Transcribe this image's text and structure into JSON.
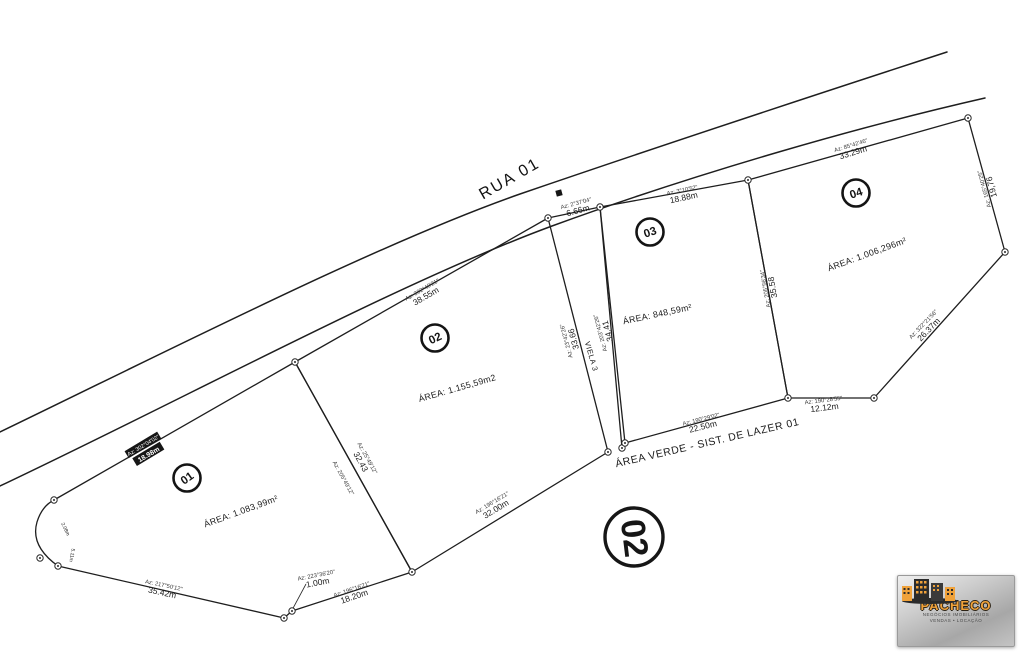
{
  "names": {
    "road_name": "RUA 01",
    "area_verde": "ÁREA VERDE - SIST. DE LAZER 01",
    "viela": "VIELA 3",
    "block_number": "02"
  },
  "lots": [
    {
      "number": "01",
      "area": "ÁREA: 1.083,99m²",
      "bubble": {
        "x": 187,
        "y": 478,
        "rot": -35
      },
      "area_label": {
        "x": 242,
        "y": 514,
        "rot": -20
      }
    },
    {
      "number": "02",
      "area": "ÁREA: 1.155,59m2",
      "bubble": {
        "x": 435,
        "y": 338,
        "rot": -25
      },
      "area_label": {
        "x": 458,
        "y": 391,
        "rot": -16
      }
    },
    {
      "number": "03",
      "area": "ÁREA: 848,59m²",
      "bubble": {
        "x": 650,
        "y": 232,
        "rot": -18
      },
      "area_label": {
        "x": 658,
        "y": 317,
        "rot": -12
      }
    },
    {
      "number": "04",
      "area": "ÁREA: 1.006,296m²",
      "bubble": {
        "x": 856,
        "y": 193,
        "rot": -18
      },
      "area_label": {
        "x": 868,
        "y": 257,
        "rot": -20
      }
    }
  ],
  "dimension_labels": [
    {
      "az": "Az: 302°40'21\"",
      "dim": "38.55m",
      "x": 424,
      "y": 293,
      "rot": -30
    },
    {
      "az": "Az: 302°04'02\"",
      "dim": "18.98m",
      "x": 146,
      "y": 450,
      "rot": -31,
      "chip": true
    },
    {
      "az": "Az: 2°37'04\"",
      "dim": "6.66m",
      "x": 577,
      "y": 207,
      "rot": -15
    },
    {
      "az": "Az: 3°10'52\"",
      "dim": "18.88m",
      "x": 683,
      "y": 194,
      "rot": -12
    },
    {
      "az": "Az: 85°42'46\"",
      "dim": "33.29m",
      "x": 852,
      "y": 149,
      "rot": -17
    },
    {
      "az": "Az: 165°40'25\"",
      "dim": "19,76",
      "x": 988,
      "y": 188,
      "rot": -105
    },
    {
      "az": "Az: 322°21'56\"",
      "dim": "26.37m",
      "x": 926,
      "y": 327,
      "rot": -46
    },
    {
      "az": "Az: 190°28'55\"",
      "dim": "12.12m",
      "x": 824,
      "y": 404,
      "rot": -7
    },
    {
      "az": "Az: 190°29'02\"",
      "dim": "22.50m",
      "x": 702,
      "y": 423,
      "rot": -14
    },
    {
      "az": "Az: 205°56'34\"",
      "dim": "35.58",
      "x": 769,
      "y": 288,
      "rot": -100
    },
    {
      "az": "Az: 203°42'26\"",
      "dim": "34.41",
      "x": 604,
      "y": 332,
      "rot": -105
    },
    {
      "az": "Az: 23°42'26\"",
      "dim": "33.66",
      "x": 570,
      "y": 340,
      "rot": -105
    },
    {
      "az": "Az: 25°49'12\"",
      "dim": "32.43",
      "x": 364,
      "y": 460,
      "rot": 61
    },
    {
      "az": "Az: 205°49'12\"",
      "dim": "",
      "x": 340,
      "y": 480,
      "rot": 61
    },
    {
      "az": "Az: 196°16'21\"",
      "dim": "32.00m",
      "x": 494,
      "y": 506,
      "rot": -31
    },
    {
      "az": "Az: 217°50'12\"",
      "dim": "35.42m",
      "x": 163,
      "y": 589,
      "rot": 12
    },
    {
      "az": "Az: 223°36'20\"",
      "dim": "1.00m",
      "x": 317,
      "y": 579,
      "rot": -11
    },
    {
      "az": "Az: 196°16'21\"",
      "dim": "18.20m",
      "x": 353,
      "y": 593,
      "rot": -19
    },
    {
      "az": "",
      "dim": "2.08m",
      "x": 70,
      "y": 527,
      "rot": 65,
      "size": 5
    },
    {
      "az": "",
      "dim": "5.11m",
      "x": 77,
      "y": 556,
      "rot": 100,
      "size": 5
    }
  ],
  "logo": {
    "brand": "PACHECO",
    "tagline1": "NEGÓCIOS IMOBILIÁRIOS",
    "tagline2": "VENDAS • LOCAÇÃO"
  },
  "colors": {
    "line": "#1e1e1e",
    "logo_orange": "#f0a23a"
  }
}
